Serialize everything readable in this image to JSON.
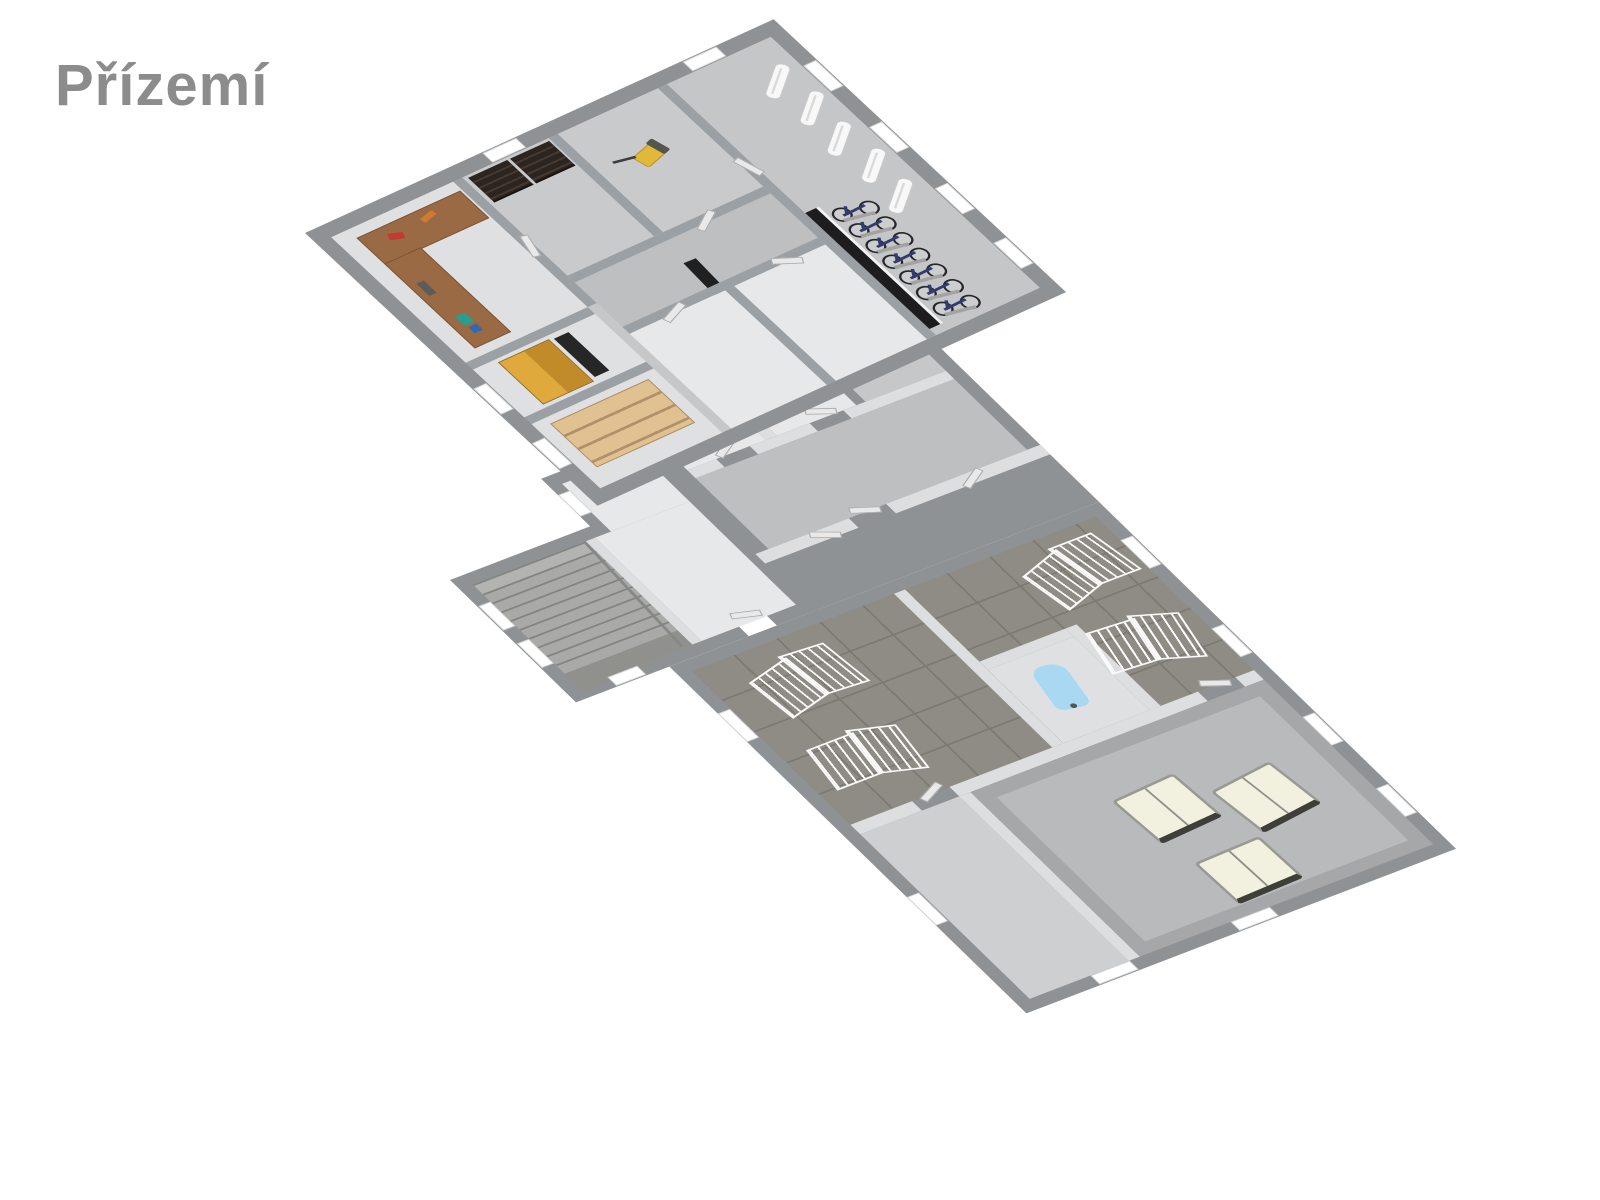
{
  "header": {
    "title": "Přízemí"
  },
  "scene": {
    "type": "3d-floor-plan-render",
    "floor_label": "Přízemí",
    "objects": [
      "l-shaped-workbench-with-tools",
      "dark-slat-shelving-units",
      "lawn-mower",
      "bicycle-row",
      "wall-mounted-ski-racks",
      "tall-yellow-cabinet",
      "dark-leaning-panels",
      "light-wood-pallet-shelf",
      "u-turn-staircase-with-railing",
      "laundry-drying-racks",
      "ironing-board",
      "white-sofas-in-hall"
    ],
    "counts": {
      "bicycles": 7,
      "ski_racks": 5,
      "drying_racks": 4,
      "sofas": 3
    }
  },
  "colors": {
    "bg": "#ffffff",
    "title": "#8c8c8c",
    "wall_ext": "#8f9295",
    "wall_int_upper": "#9ba0a4",
    "wall_int_lower": "#dcdedf",
    "floor_white": "#e7e8e9",
    "floor_light": "#dfe0e2",
    "floor_mid": "#c9cacc",
    "floor_corridor": "#bdbfc1",
    "floor_bike": "#c5c6c8",
    "floor_underlay": "#c6c7c9",
    "floor_tile": "#8f8c85",
    "tile_line": "#7d7a73",
    "floor_hall_left": "#cdcfd1",
    "floor_hall_big": "#a5a7a9",
    "floor_hall_inner": "#b8babc",
    "stair_tread": "#a9a9a7",
    "stair_edge": "#83837f",
    "stair_landing": "#90908c",
    "rail": "#87878a",
    "desk_wood": "#9a6a45",
    "desk_edge": "#7b5333",
    "shelf_dark": "#2c241f",
    "shelf_dark_slat": "#463a32",
    "cabinet_yellow": "#c08b28",
    "cabinet_edge": "#8f671d",
    "shelf_tan": "#e0c191",
    "shelf_tan_line": "#b2906a",
    "panel_dark": "#1d1d1f",
    "mower_yellow": "#e0b83a",
    "mower_dark": "#55544f",
    "bike_wheel": "#26262a",
    "bike_frame": "#333a6e",
    "rack_white": "#f8f8f8",
    "dryrack_white": "#fbfbfb",
    "sofa_cream": "#f2f0de",
    "sofa_dark": "#3f3f39",
    "sofa_edge": "#8e8e88",
    "iron_blue": "#a8d8f2",
    "window_white": "#ffffff",
    "door_leaf": "#e9e9e9",
    "door_edge": "#aaaaaa"
  }
}
